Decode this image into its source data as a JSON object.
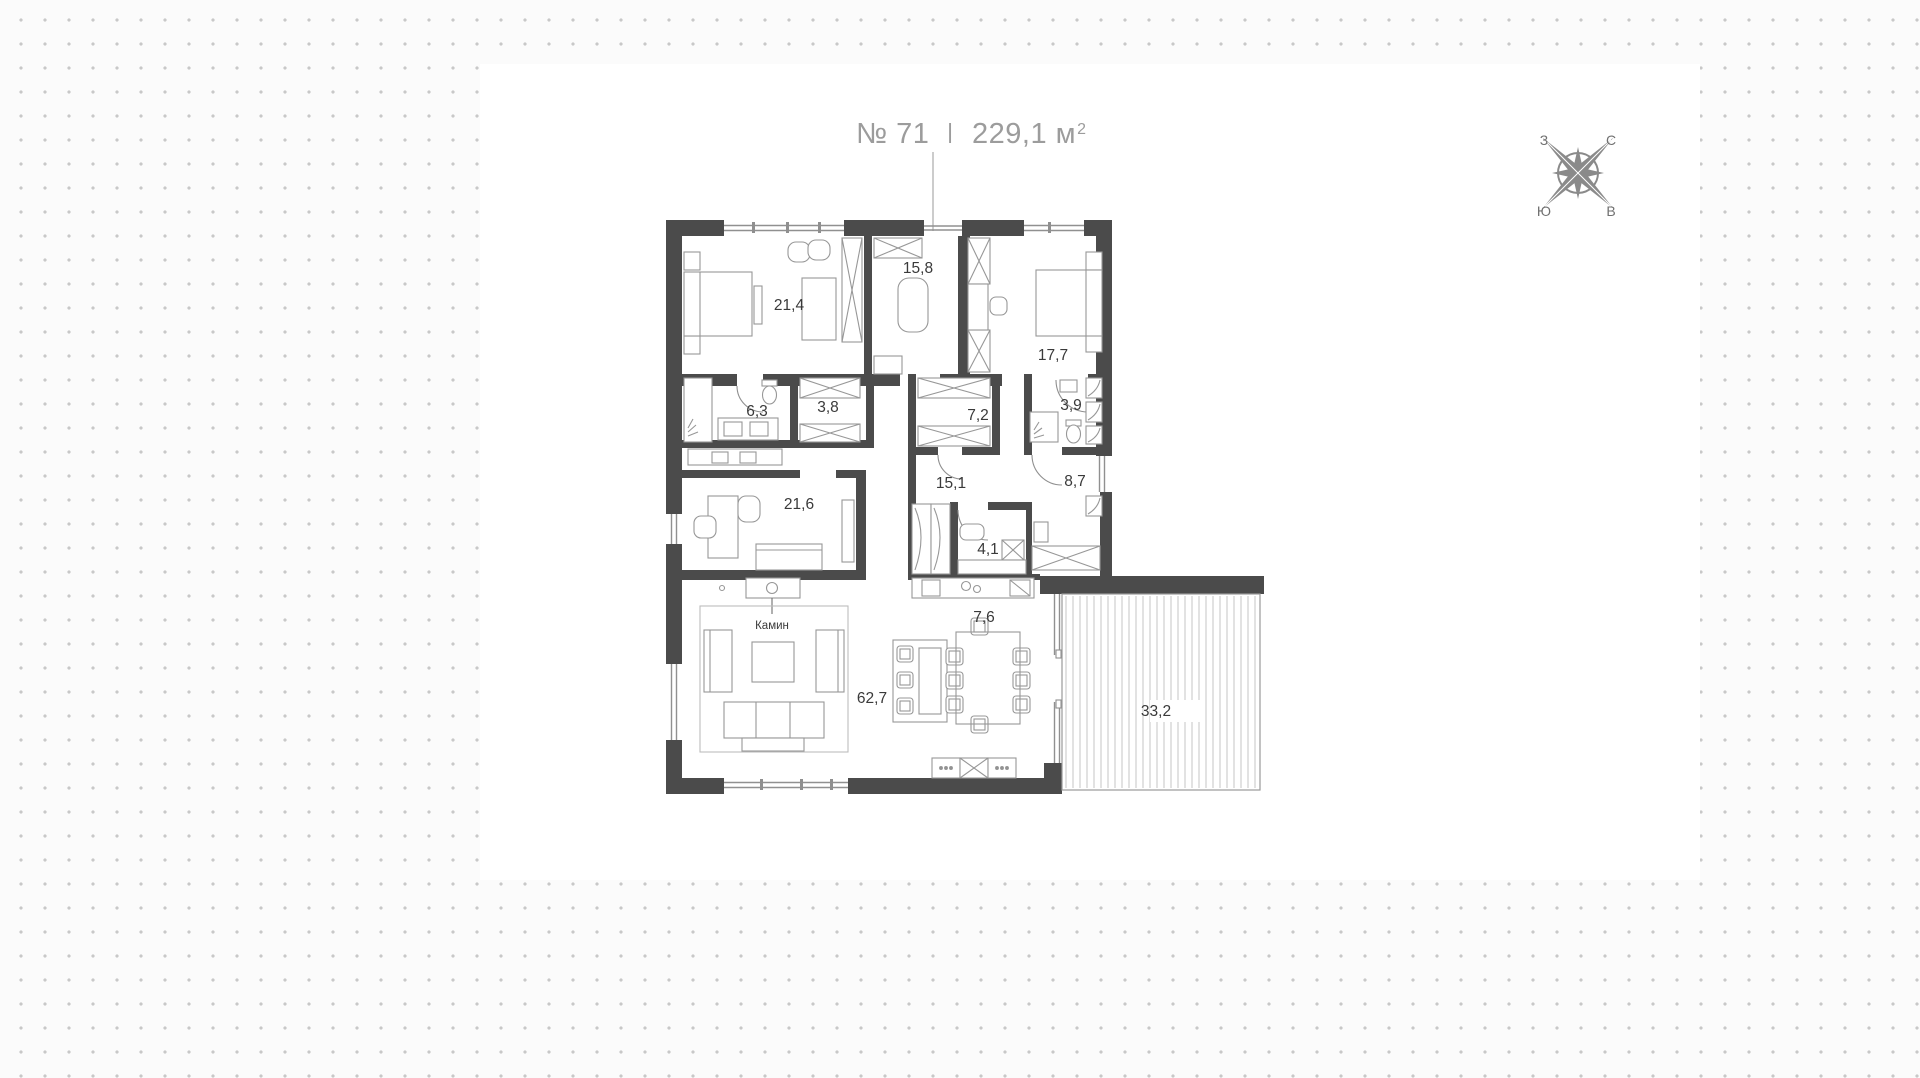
{
  "title": {
    "number": "№ 71",
    "divider": "I",
    "area_value": "229,1",
    "area_unit": "м",
    "area_sup": "2"
  },
  "compass": {
    "west": "З",
    "north": "С",
    "south": "Ю",
    "east": "В"
  },
  "plan": {
    "rooms": [
      {
        "name": "bedroom-1",
        "area": "21,4"
      },
      {
        "name": "entry-hall",
        "area": "15,8"
      },
      {
        "name": "bedroom-2",
        "area": "17,7"
      },
      {
        "name": "bathroom",
        "area": "6,3"
      },
      {
        "name": "wardrobe-1",
        "area": "3,8"
      },
      {
        "name": "wardrobe-2",
        "area": "7,2"
      },
      {
        "name": "shower-room",
        "area": "3,9"
      },
      {
        "name": "hall",
        "area": "15,1"
      },
      {
        "name": "corridor",
        "area": "8,7"
      },
      {
        "name": "study",
        "area": "21,6"
      },
      {
        "name": "laundry",
        "area": "4,1"
      },
      {
        "name": "kitchen",
        "area": "7,6"
      },
      {
        "name": "living-room",
        "area": "62,7"
      },
      {
        "name": "terrace",
        "area": "33,2"
      }
    ],
    "annotations": {
      "fireplace": "Камин"
    },
    "colors": {
      "wall": "#4b4b4b",
      "furniture": "#8f8f8f",
      "label": "#3a3a3a",
      "title": "#9c9c9c",
      "compass": "#8a8a8a",
      "dots": "#c8c8c8"
    }
  }
}
